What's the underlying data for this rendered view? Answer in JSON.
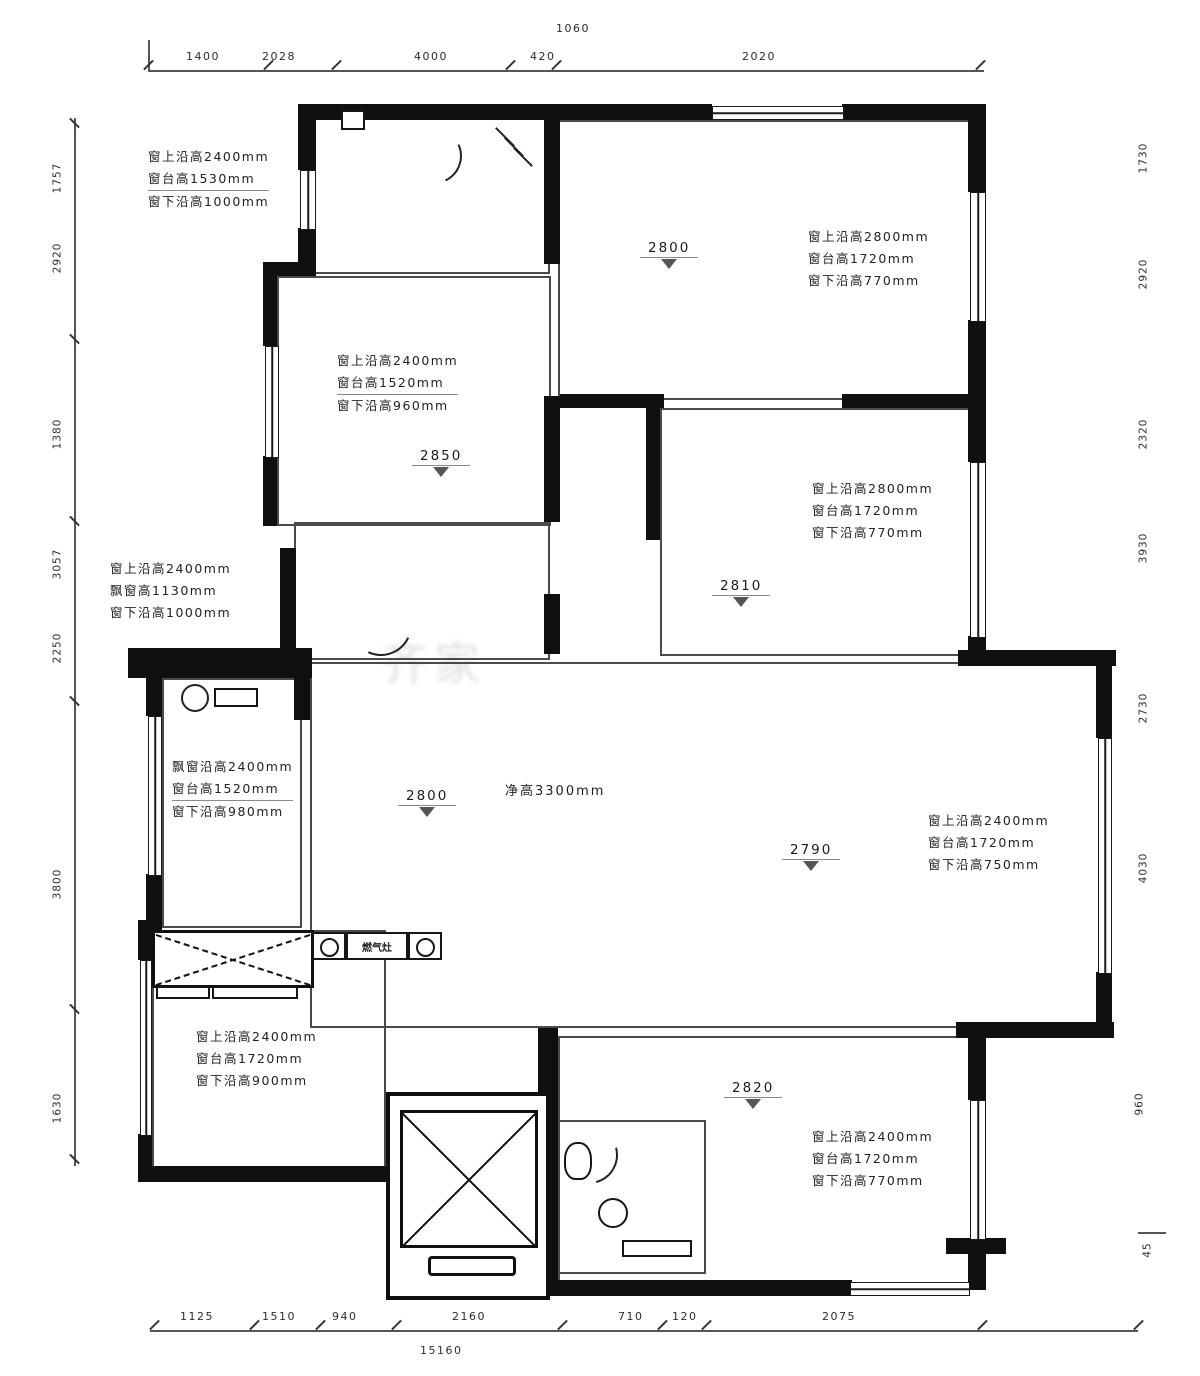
{
  "colors": {
    "wall": "#101010",
    "thin_line": "#4a4a4a",
    "text": "#1f1f1f",
    "dim_line": "#555555"
  },
  "dims": {
    "top": [
      "1400",
      "2028",
      "4000",
      "420",
      "2020"
    ],
    "top_small": "1060",
    "bottom": [
      "1125",
      "1510",
      "940",
      "2160",
      "710",
      "120",
      "2075"
    ],
    "bottom_total": "15160",
    "left": [
      "1757",
      "2920",
      "1380",
      "3057",
      "2250",
      "3800",
      "1630"
    ],
    "right": [
      "1730",
      "2920",
      "2320",
      "3930",
      "2730",
      "4030",
      "960",
      "45"
    ]
  },
  "room_dims": {
    "bed1": "2850",
    "top_right": "2800",
    "right": "2810",
    "living": "2800",
    "living_right": "2790",
    "bottom_right": "2820",
    "living_height": "净高3300mm"
  },
  "ann": {
    "a1": [
      "窗上沿高2400mm",
      "窗台高1530mm",
      "窗下沿高1000mm"
    ],
    "a2": [
      "窗上沿高2400mm",
      "窗台高1520mm",
      "窗下沿高960mm"
    ],
    "a3": [
      "窗上沿高2800mm",
      "窗台高1720mm",
      "窗下沿高770mm"
    ],
    "a4": [
      "窗上沿高2800mm",
      "窗台高1720mm",
      "窗下沿高770mm"
    ],
    "a5": [
      "窗上沿高2400mm",
      "飘窗高1130mm",
      "窗下沿高1000mm"
    ],
    "a6": [
      "飘窗沿高2400mm",
      "窗台高1520mm",
      "窗下沿高980mm"
    ],
    "a7": [
      "窗上沿高2400mm",
      "窗台高1720mm",
      "窗下沿高750mm"
    ],
    "a8": [
      "窗上沿高2400mm",
      "窗台高1720mm",
      "窗下沿高900mm"
    ],
    "a9": [
      "窗上沿高2400mm",
      "窗台高1720mm",
      "窗下沿高770mm"
    ]
  },
  "labels": {
    "stove": "燃气灶"
  }
}
